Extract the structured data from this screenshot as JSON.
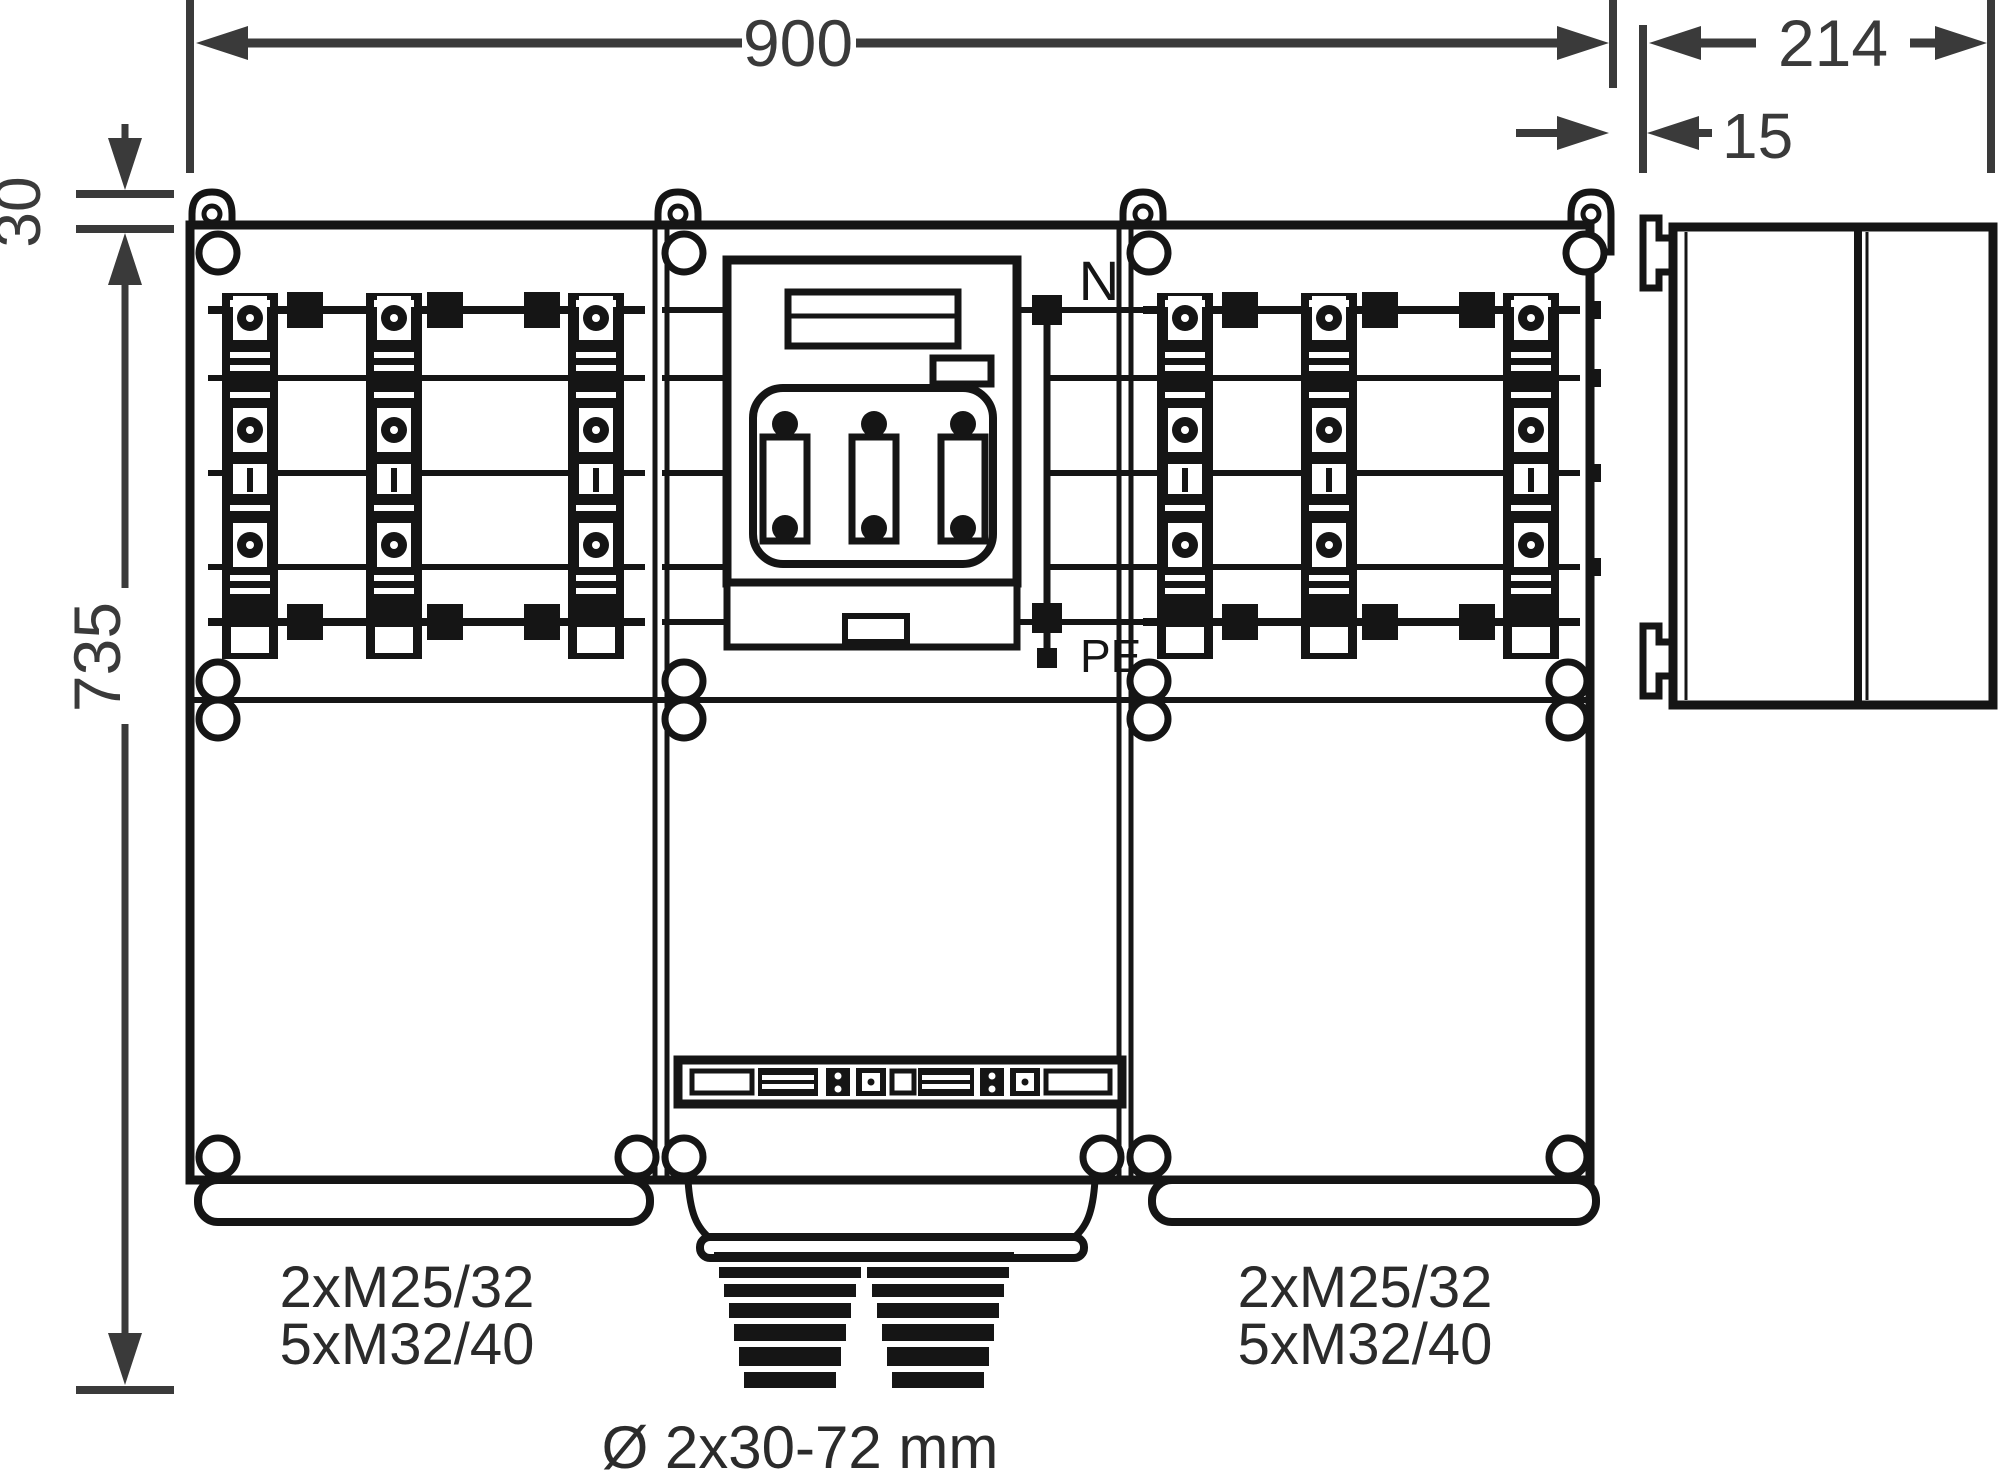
{
  "colors": {
    "ink": "#151515",
    "dim": "#3a3a3a",
    "bg": "#ffffff"
  },
  "dimensions": {
    "total_width_mm": "900",
    "side_depth_mm": "214",
    "panel_gap_mm": "15",
    "lug_offset_mm": "30",
    "total_height_mm": "735"
  },
  "terminals": {
    "neutral": "N",
    "protective_earth": "PE"
  },
  "gland_labels": {
    "left_line1": "2xM25/32",
    "left_line2": "5xM32/40",
    "right_line1": "2xM25/32",
    "right_line2": "5xM32/40",
    "cable_entry_range": "Ø 2x30-72 mm"
  },
  "icons": {
    "seal_lug": "padlock-seal-lug-icon",
    "corner_fastener": "hinge-circle-icon",
    "dimension_arrow": "dimension-arrow-icon"
  }
}
